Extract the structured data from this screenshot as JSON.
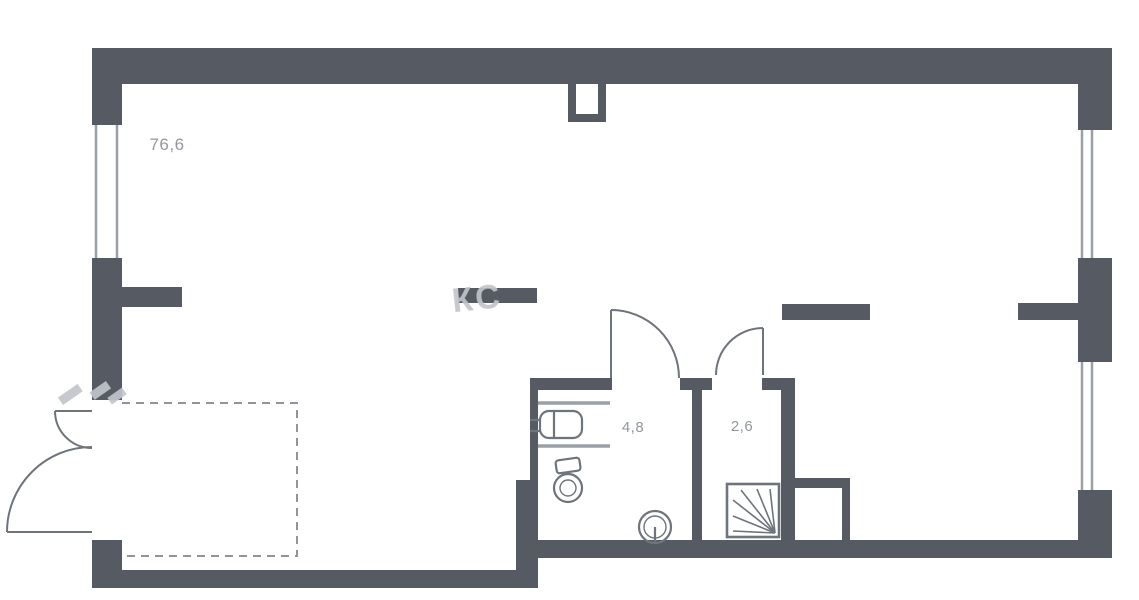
{
  "plan": {
    "rooms": [
      {
        "name": "main-room",
        "area_label": "76,6"
      },
      {
        "name": "bathroom",
        "area_label": "4,8"
      },
      {
        "name": "hall",
        "area_label": "2,6"
      }
    ],
    "watermark_text": "КС",
    "colors": {
      "wall": "#565b63",
      "fixture_line": "#6e747c",
      "window_line": "#9aa0a7",
      "label_text": "#9297a0",
      "watermark": "#c2c5cb",
      "dashed_line": "#90959d",
      "background": "#ffffff"
    },
    "icons": [
      "ventilation-shaft",
      "sink",
      "toilet",
      "floor-drain",
      "shower-tray",
      "door-swing"
    ]
  }
}
